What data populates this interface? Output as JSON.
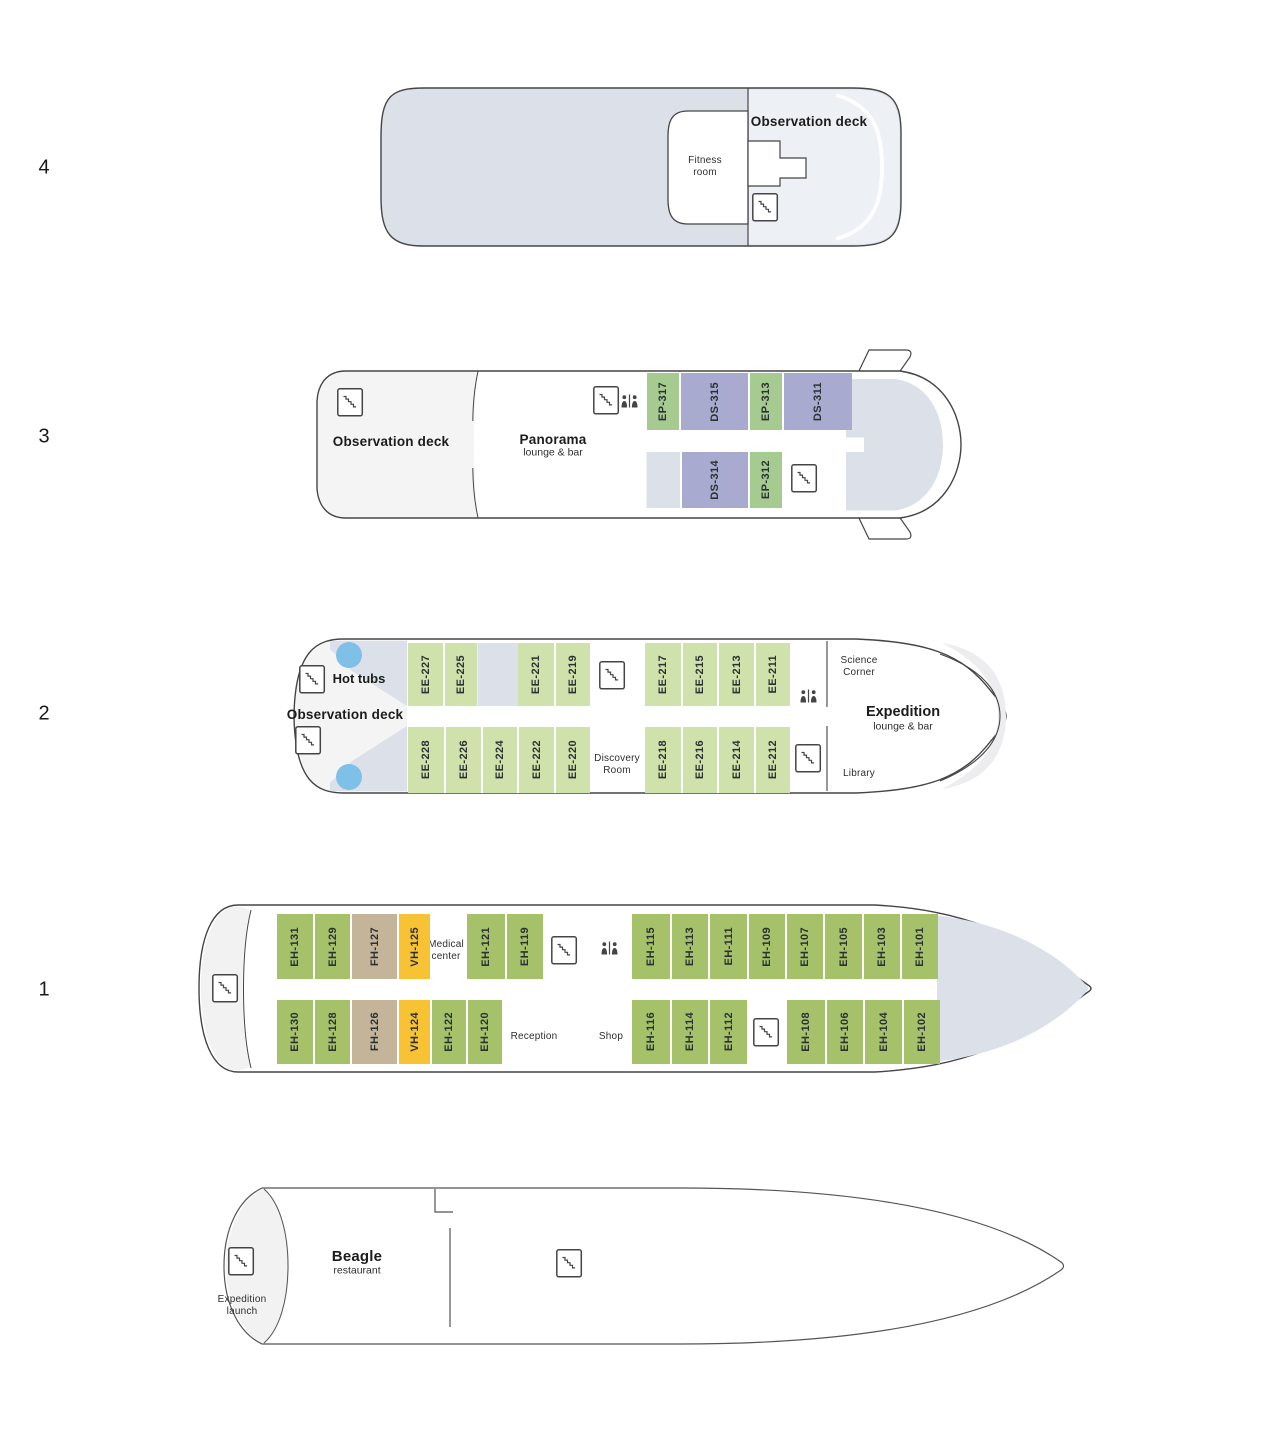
{
  "palette": {
    "deck_shade": "#dce1e9",
    "deck_shade_light": "#edf0f4",
    "pale": "#f4f4f5",
    "stern_pale": "#f2f2f3",
    "ep_green": "#a6cb90",
    "ds_purple": "#a9aad0",
    "ee_green": "#cfe2ab",
    "eh_green": "#a5c169",
    "fh_tan": "#c4b59a",
    "vh_yellow": "#f7c335",
    "hot_tub_blue": "#7fc0e8",
    "outline": "#454545"
  },
  "icons": {
    "stairs": "staircase-in-square",
    "elevator": "two-figures-with-divider",
    "hot_tub": "blue-circle"
  },
  "decks": {
    "d4": {
      "number": "4",
      "labels": {
        "observation_deck": "Observation deck",
        "fitness_room": "Fitness\nroom"
      }
    },
    "d3": {
      "number": "3",
      "labels": {
        "observation_deck": "Observation deck",
        "panorama": "Panorama",
        "panorama_sub": "lounge & bar"
      },
      "cabins_top": [
        {
          "id": "EP-317"
        },
        {
          "id": "DS-315"
        },
        {
          "id": "EP-313"
        },
        {
          "id": "DS-311"
        }
      ],
      "cabins_bottom": [
        {
          "id": "DS-314"
        },
        {
          "id": "EP-312"
        }
      ]
    },
    "d2": {
      "number": "2",
      "labels": {
        "hot_tubs": "Hot tubs",
        "observation_deck": "Observation deck",
        "science_corner": "Science\nCorner",
        "expedition": "Expedition",
        "expedition_sub": "lounge & bar",
        "library": "Library",
        "discovery_room": "Discovery\nRoom"
      },
      "cabins_top": [
        {
          "id": "EE-227"
        },
        {
          "id": "EE-225"
        },
        {
          "id": "EE-221"
        },
        {
          "id": "EE-219"
        },
        {
          "id": "EE-217"
        },
        {
          "id": "EE-215"
        },
        {
          "id": "EE-213"
        },
        {
          "id": "EE-211"
        }
      ],
      "cabins_bottom": [
        {
          "id": "EE-228"
        },
        {
          "id": "EE-226"
        },
        {
          "id": "EE-224"
        },
        {
          "id": "EE-222"
        },
        {
          "id": "EE-220"
        },
        {
          "id": "EE-218"
        },
        {
          "id": "EE-216"
        },
        {
          "id": "EE-214"
        },
        {
          "id": "EE-212"
        }
      ]
    },
    "d1": {
      "number": "1",
      "labels": {
        "medical_center": "Medical\ncenter",
        "reception": "Reception",
        "shop": "Shop"
      },
      "cabins_top": [
        {
          "id": "EH-131"
        },
        {
          "id": "EH-129"
        },
        {
          "id": "FH-127"
        },
        {
          "id": "VH-125"
        },
        {
          "id": "EH-121"
        },
        {
          "id": "EH-119"
        },
        {
          "id": "EH-115"
        },
        {
          "id": "EH-113"
        },
        {
          "id": "EH-111"
        },
        {
          "id": "EH-109"
        },
        {
          "id": "EH-107"
        },
        {
          "id": "EH-105"
        },
        {
          "id": "EH-103"
        },
        {
          "id": "EH-101"
        }
      ],
      "cabins_bottom": [
        {
          "id": "EH-130"
        },
        {
          "id": "EH-128"
        },
        {
          "id": "FH-126"
        },
        {
          "id": "VH-124"
        },
        {
          "id": "EH-122"
        },
        {
          "id": "EH-120"
        },
        {
          "id": "EH-116"
        },
        {
          "id": "EH-114"
        },
        {
          "id": "EH-112"
        },
        {
          "id": "EH-108"
        },
        {
          "id": "EH-106"
        },
        {
          "id": "EH-104"
        },
        {
          "id": "EH-102"
        }
      ]
    },
    "d0": {
      "labels": {
        "beagle": "Beagle",
        "beagle_sub": "restaurant",
        "expedition_launch": "Expedition\nlaunch"
      }
    }
  }
}
